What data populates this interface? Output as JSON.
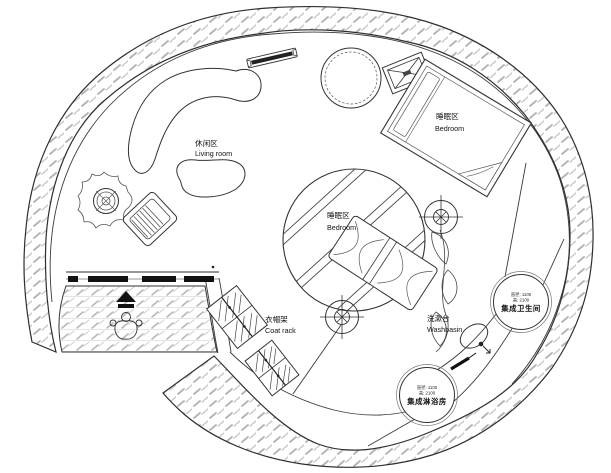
{
  "plan": {
    "living_room": {
      "label_zh": "休闲区",
      "label_en": "Living room"
    },
    "bedroom_upper": {
      "label_zh": "睡眠区",
      "label_en": "Bedroom"
    },
    "bedroom_center": {
      "label_zh": "睡眠区",
      "label_en": "Bedroom"
    },
    "coat_rack": {
      "label_zh": "衣帽架",
      "label_en": "Coat rack"
    },
    "washbasin": {
      "label_zh": "洗漱台",
      "label_en": "Washbasin"
    },
    "bathroom_pod": {
      "spec_diameter": "直径: 1100",
      "spec_height": "高: 2100",
      "label_zh": "集成卫生间"
    },
    "shower_pod": {
      "spec_diameter": "直径: 1100",
      "spec_height": "高: 2100",
      "label_zh": "集成淋浴房"
    }
  },
  "colors": {
    "ink": "#2e2e2e",
    "hatch": "#b3b3b3",
    "paper": "#ffffff"
  }
}
